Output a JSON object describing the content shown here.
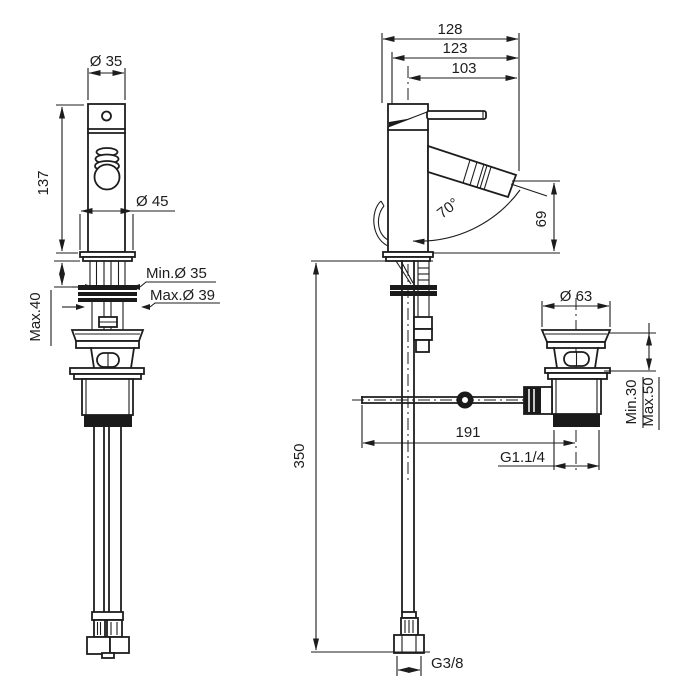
{
  "drawing": {
    "title": "bidet-mixer-technical-drawing",
    "background": "#ffffff",
    "line_color": "#1d1d1d",
    "front_view": {
      "top_diameter": "Ø 35",
      "body_height": "137",
      "base_diameter": "Ø 45",
      "hole_min_diameter": "Min.Ø 35",
      "hole_max_diameter": "Max.Ø 39",
      "deck_thickness_max": "Max.40"
    },
    "side_view": {
      "total_depth": "128",
      "handle_depth": "123",
      "spout_reach": "103",
      "spout_angle": "70°",
      "spout_height": "69",
      "hose_drop": "350",
      "rod_reach": "191",
      "waste_flange_diameter": "Ø 63",
      "waste_clamp_min": "Min.30",
      "waste_clamp_max": "Max.50",
      "waste_thread": "G1.1/4",
      "supply_thread": "G3/8"
    }
  }
}
